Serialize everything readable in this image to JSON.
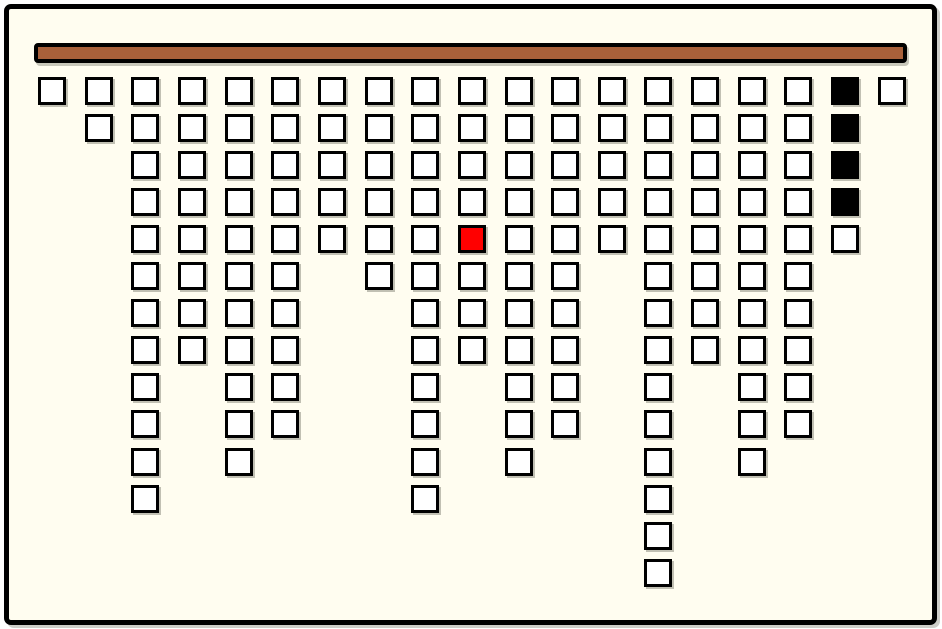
{
  "board": {
    "width": 942,
    "height": 629,
    "outer_background": "#FFFFFF",
    "inner_background": "#FFFDF0",
    "frame": {
      "x": 4,
      "y": 4,
      "w": 933,
      "h": 621,
      "border_color": "#000000",
      "border_width": 5,
      "radius": 7
    },
    "bar": {
      "x": 34,
      "y": 43,
      "w": 873,
      "h": 20,
      "fill": "#A8603A",
      "border_color": "#000000",
      "border_width": 4
    },
    "grid": {
      "cols": 19,
      "rows": 14,
      "origin_x": 38,
      "origin_y": 77,
      "col_spacing": 46.65,
      "row_spacing": 37.05,
      "cell_size": 28,
      "cell_border": 3,
      "cell_border_color": "#000000",
      "colors": {
        "white": "#FFFFFF",
        "black": "#000000",
        "red": "#FF0000"
      },
      "column_heights": [
        1,
        2,
        12,
        8,
        11,
        10,
        5,
        6,
        12,
        8,
        11,
        10,
        5,
        14,
        8,
        11,
        10,
        5,
        1
      ],
      "special_cells": [
        {
          "col": 10,
          "row": 5,
          "color": "red",
          "name": "red-tile"
        },
        {
          "col": 18,
          "row": 1,
          "color": "black",
          "name": "black-tile"
        },
        {
          "col": 18,
          "row": 2,
          "color": "black",
          "name": "black-tile"
        },
        {
          "col": 18,
          "row": 3,
          "color": "black",
          "name": "black-tile"
        },
        {
          "col": 18,
          "row": 4,
          "color": "black",
          "name": "black-tile"
        }
      ],
      "tile_counts": {
        "total": 150,
        "white": 145,
        "black": 4,
        "red": 1
      }
    }
  }
}
